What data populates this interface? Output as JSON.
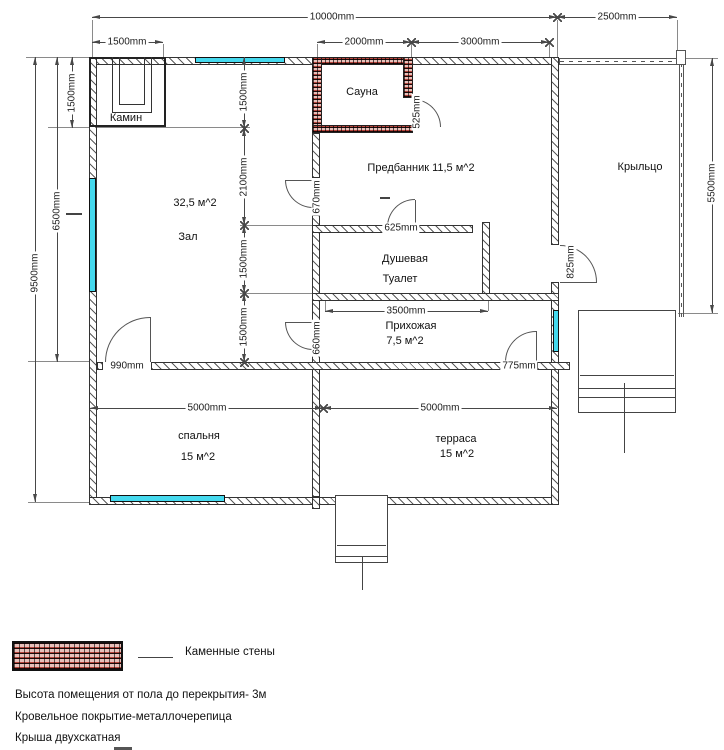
{
  "drawing": {
    "rooms": {
      "kamin": "Камин",
      "sauna": "Сауна",
      "predbannik": "Предбанник 11,5 м^2",
      "kryltso": "Крыльцо",
      "zal_area": "32,5 м^2",
      "zal": "Зал",
      "dushevaya": "Душевая",
      "tualet": "Туалет",
      "prihozhaya": "Прихожая",
      "prihozhaya_area": "7,5 м^2",
      "spalnya": "спальня",
      "spalnya_area": "15 м^2",
      "terrasa": "терраса",
      "terrasa_area": "15 м^2"
    },
    "dims": {
      "w10000": "10000mm",
      "w2500": "2500mm",
      "w1500": "1500mm",
      "w2000": "2000mm",
      "w3000": "3000mm",
      "h1500_left": "1500mm",
      "h6500": "6500mm",
      "h9500": "9500mm",
      "c1500a": "1500mm",
      "c2100": "2100mm",
      "c1500b": "1500mm",
      "c1500c": "1500mm",
      "h5500": "5500mm",
      "w3500": "3500mm",
      "w5000a": "5000mm",
      "w5000b": "5000mm",
      "d670": "670mm",
      "d625": "625mm",
      "d525": "525mm",
      "d825": "825mm",
      "d660": "660mm",
      "d990": "990mm",
      "d775": "775mm"
    },
    "legend": {
      "label": "Каменные стены"
    },
    "notes": {
      "line1": "Высота помещения от пола до перекрытия- 3м",
      "line2": "Кровельное покрытие-металлочерепица",
      "line3": "Крыша двухскатная"
    }
  },
  "colors": {
    "window": "#45d9ee",
    "brick": "#b5443b",
    "wall_line": "#333333",
    "dim_line": "#484848"
  }
}
